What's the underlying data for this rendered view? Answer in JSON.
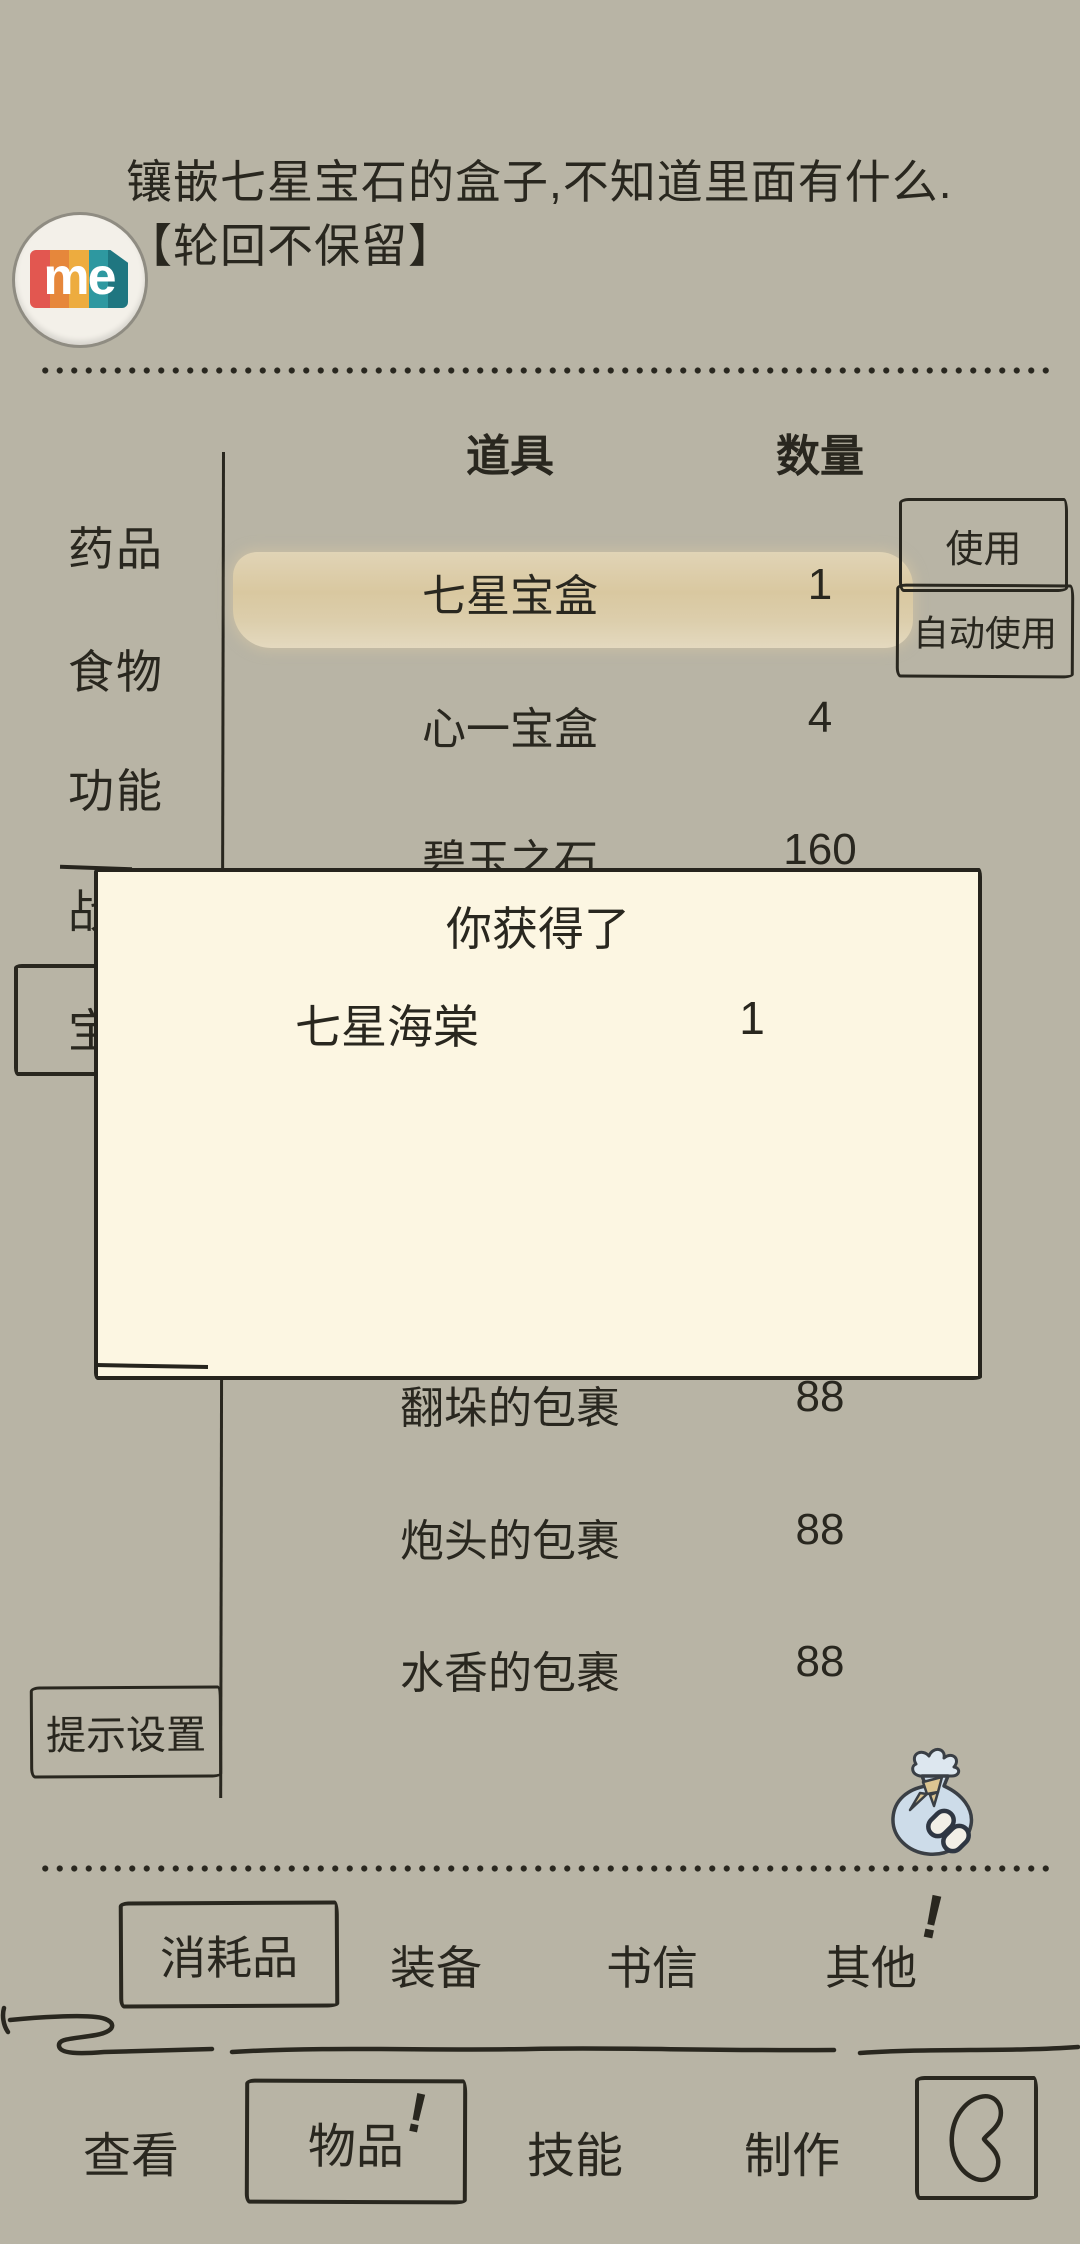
{
  "colors": {
    "background": "#b8b4a5",
    "ink": "#29271f",
    "dialog_cream": "#fcf6e2",
    "row_highlight_tan": "#d9c8a0",
    "money_bag_blue": "#cddce9",
    "ribbon_tan": "#dcc592",
    "logo_red": "#e25750",
    "logo_orange": "#e6873b",
    "logo_amber": "#edac3f",
    "logo_teal": "#2e98a0",
    "logo_teal_dark": "#1f7680"
  },
  "item_description": {
    "line1": "镶嵌七星宝石的盒子,不知道里面有什么.",
    "line2": "【轮回不保留】"
  },
  "logo": {
    "text": "me"
  },
  "inventory": {
    "columns": {
      "item": "道具",
      "quantity": "数量"
    },
    "categories": [
      {
        "label": "药品"
      },
      {
        "label": "食物"
      },
      {
        "label": "功能"
      },
      {
        "label": "战"
      },
      {
        "label": "宝",
        "selected": true
      }
    ],
    "rows": [
      {
        "name": "七星宝盒",
        "quantity": "1",
        "highlighted": true
      },
      {
        "name": "心一宝盒",
        "quantity": "4"
      },
      {
        "name": "碧玉之石",
        "quantity": "160"
      },
      {
        "name": "翻垛的包裹",
        "quantity": "88"
      },
      {
        "name": "炮头的包裹",
        "quantity": "88"
      },
      {
        "name": "水香的包裹",
        "quantity": "88"
      }
    ],
    "use_button": "使用",
    "auto_use_button": "自动使用",
    "hint_settings_button": "提示设置"
  },
  "reward_dialog": {
    "title": "你获得了",
    "rows": [
      {
        "name": "七星海棠",
        "quantity": "1"
      }
    ]
  },
  "category_tabs": [
    {
      "label": "消耗品",
      "selected": true
    },
    {
      "label": "装备"
    },
    {
      "label": "书信"
    },
    {
      "label": "其他",
      "badge": "!"
    }
  ],
  "bottom_nav": [
    {
      "label": "查看"
    },
    {
      "label": "物品",
      "selected": true,
      "badge": "!"
    },
    {
      "label": "技能"
    },
    {
      "label": "制作"
    }
  ],
  "icons": {
    "logo": "me-logo",
    "money_bag": "money-bag-icon",
    "chain_link": "chain-link-icon",
    "back": "back-icon"
  }
}
